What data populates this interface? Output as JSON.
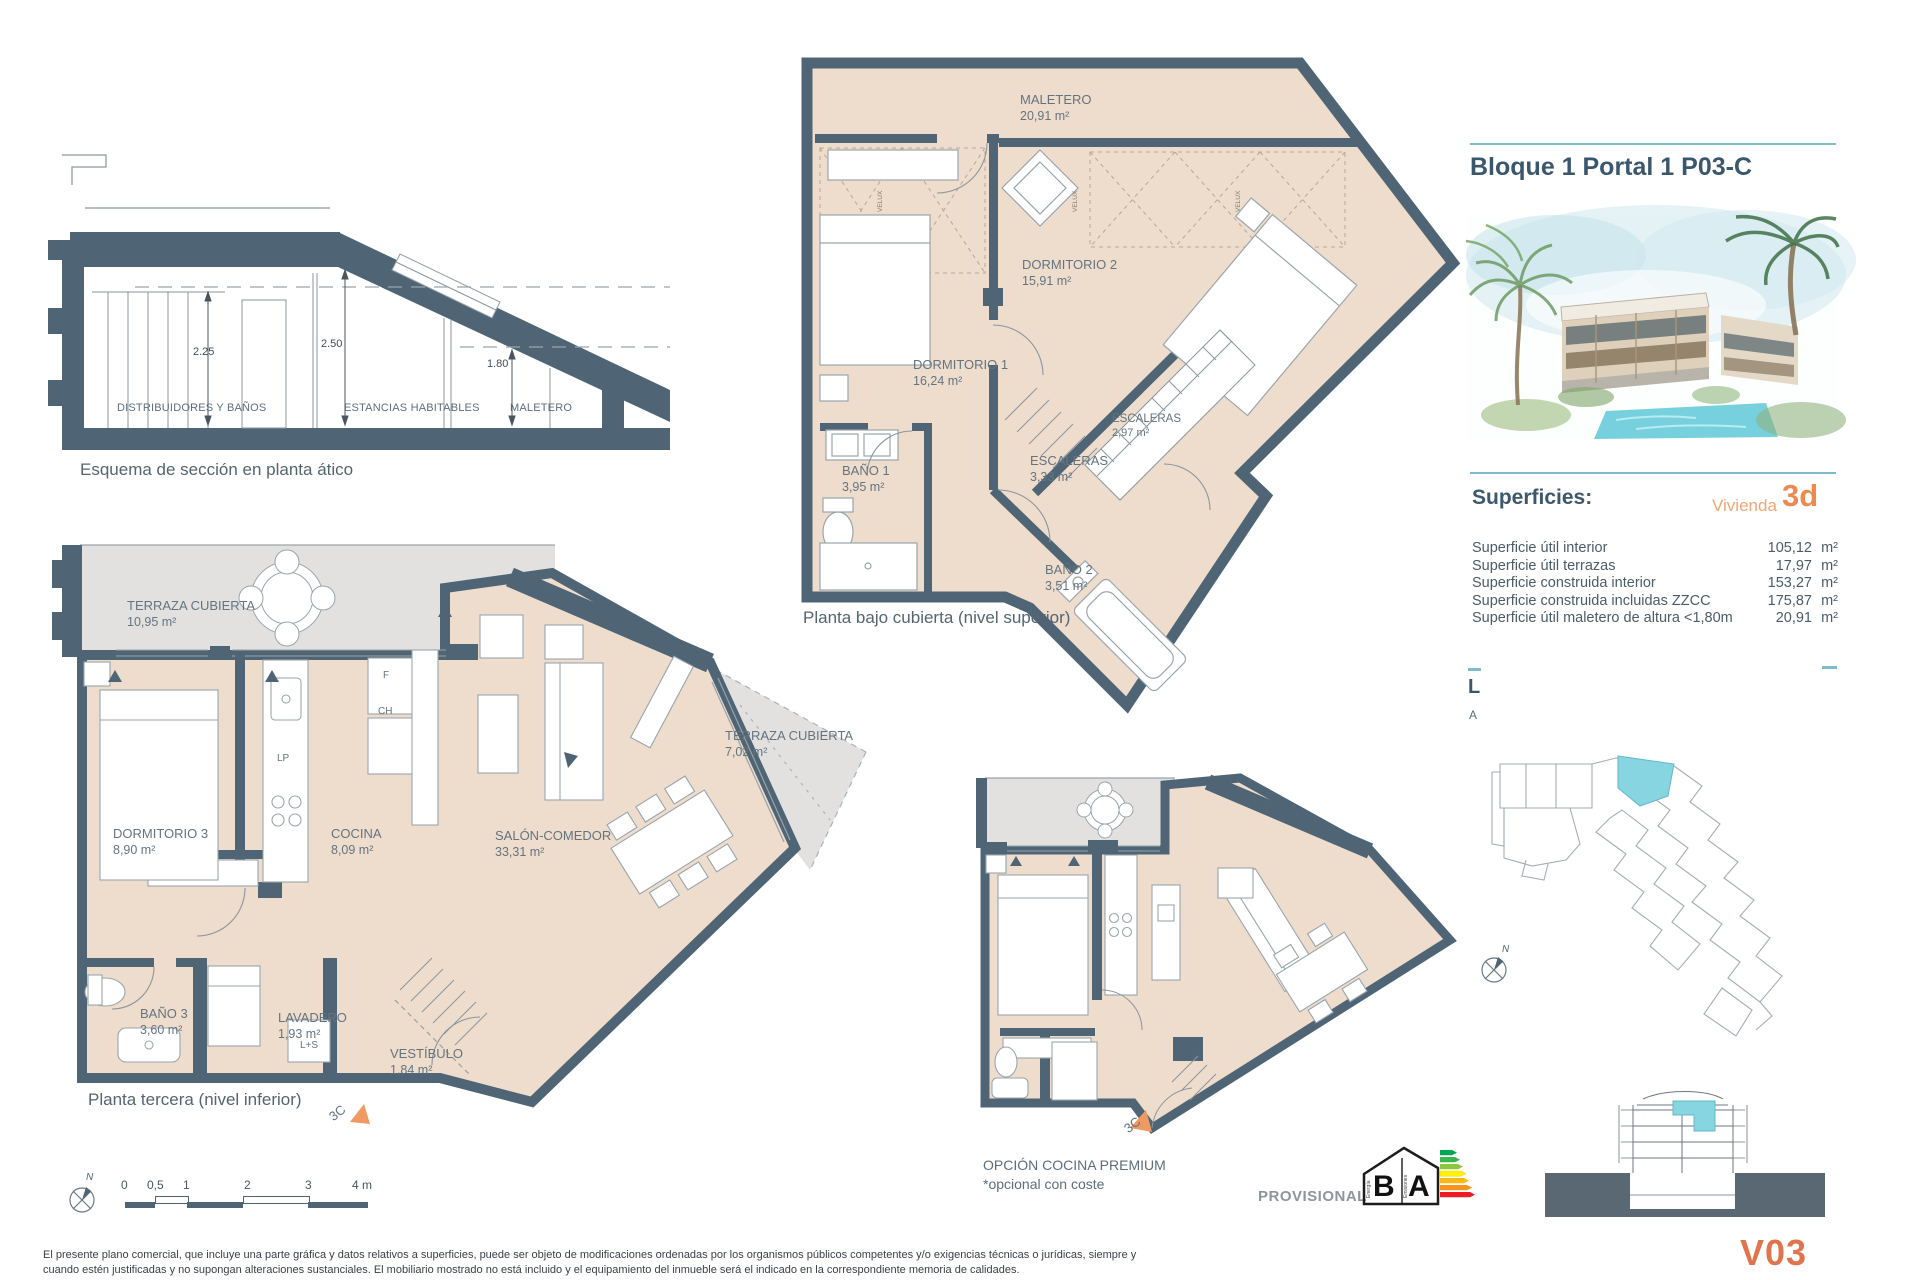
{
  "palette": {
    "wall": "#4f6575",
    "floor": "#eedccd",
    "terrace": "#e2e1e0",
    "accent_teal": "#7cbccb",
    "highlight": "#86d5e0",
    "orange": "#ec8a50",
    "orange_light": "#f0a678",
    "orange_deep": "#e0744c",
    "heading": "#3a576d",
    "label": "#64747f"
  },
  "header": {
    "title": "Bloque 1 Portal 1 P03-C"
  },
  "section_schema": {
    "caption": "Esquema de sección en planta ático",
    "dim_left": "2.25",
    "dim_mid": "2.50",
    "dim_right": "1.80",
    "zone_left": "DISTRIBUIDORES Y BAÑOS",
    "zone_mid": "ESTANCIAS HABITABLES",
    "zone_right": "MALETERO"
  },
  "upper_plan": {
    "caption": "Planta bajo cubierta (nivel superior)",
    "velux_tag": "VELUX",
    "rooms": [
      {
        "name": "MALETERO",
        "area": "20,91 m²"
      },
      {
        "name": "DORMITORIO 2",
        "area": "15,91 m²"
      },
      {
        "name": "DORMITORIO 1",
        "area": "16,24 m²"
      },
      {
        "name": "BAÑO 1",
        "area": "3,95 m²"
      },
      {
        "name": "ESCALERAS",
        "area": "3,33 m²"
      },
      {
        "name": "ESCALERAS",
        "area": "2,97 m²"
      },
      {
        "name": "BAÑO 2",
        "area": "3,51 m²"
      }
    ]
  },
  "lower_plan": {
    "caption": "Planta tercera (nivel inferior)",
    "entry_tag": "3C",
    "tags": {
      "f": "F",
      "ch": "CH",
      "lp": "LP",
      "ls": "L+S"
    },
    "rooms": [
      {
        "name": "TERRAZA CUBIERTA",
        "area": "10,95 m²"
      },
      {
        "name": "DORMITORIO 3",
        "area": "8,90 m²"
      },
      {
        "name": "COCINA",
        "area": "8,09 m²"
      },
      {
        "name": "SALÓN-COMEDOR",
        "area": "33,31 m²"
      },
      {
        "name": "TERRAZA CUBIERTA",
        "area": "7,02 m²"
      },
      {
        "name": "BAÑO 3",
        "area": "3,60 m²"
      },
      {
        "name": "LAVADERO",
        "area": "1,93 m²"
      },
      {
        "name": "VESTÍBULO",
        "area": "1,84 m²"
      }
    ]
  },
  "premium_plan": {
    "caption_line1": "OPCIÓN COCINA PREMIUM",
    "caption_line2": "*opcional con coste",
    "entry_tag": "3C"
  },
  "surfaces": {
    "heading": "Superficies:",
    "unit_label": "Vivienda",
    "unit_code": "3d",
    "rows": [
      {
        "label": "Superficie útil interior",
        "value": "105,12",
        "unit": "m²"
      },
      {
        "label": "Superficie útil terrazas",
        "value": "17,97",
        "unit": "m²"
      },
      {
        "label": "Superficie construida interior",
        "value": "153,27",
        "unit": "m²"
      },
      {
        "label": "Superficie construida incluidas ZZCC",
        "value": "175,87",
        "unit": "m²"
      },
      {
        "label": "Superficie útil maletero de altura <1,80m",
        "value": "20,91",
        "unit": "m²"
      }
    ]
  },
  "clipped_heading": {
    "line1": "L",
    "line2": "A"
  },
  "compass_label": "N",
  "scalebar": {
    "labels": [
      "0",
      "0,5",
      "1",
      "2",
      "3",
      "4 m"
    ]
  },
  "energy": {
    "status": "PROVISIONAL",
    "letter_left": "B",
    "letter_right": "A",
    "axis_left": "Energía",
    "axis_right": "Emisiones"
  },
  "version_code": "V03",
  "disclaimer": {
    "line1": "El presente plano comercial, que incluye una parte gráfica y datos relativos a superficies, puede ser objeto de modificaciones ordenadas por los organismos públicos competentes y/o exigencias técnicas o jurídicas, siempre y",
    "line2": "cuando estén justificadas y no supongan alteraciones sustanciales. El mobiliario mostrado no está incluido y el equipamiento del inmueble será el indicado en la correspondiente memoria de calidades."
  }
}
